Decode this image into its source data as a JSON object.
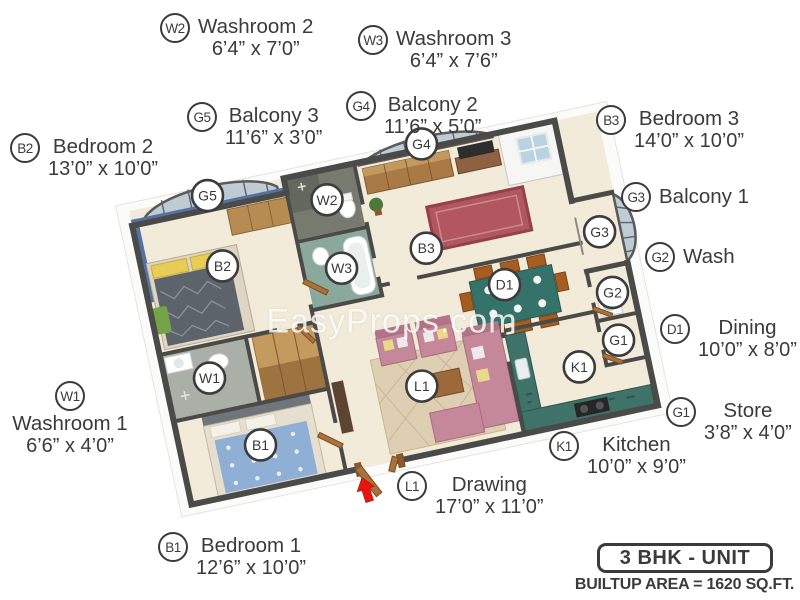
{
  "watermark": "EasyProps.com",
  "palette": {
    "ink": "#3b3b3b",
    "wall": "#4a4a48",
    "floor": "#f3ebd9",
    "accent_blue": "#5571a2",
    "kitchen_teal": "#3f7268",
    "sofa_pink": "#c5879a",
    "arrow_red": "#e81410",
    "glass": "#b9c8d2"
  },
  "legend": {
    "w2": {
      "code": "W2",
      "name": "Washroom 2",
      "dims": "6’4” x 7’0”"
    },
    "w3": {
      "code": "W3",
      "name": "Washroom 3",
      "dims": "6’4” x 7’6”"
    },
    "g5": {
      "code": "G5",
      "name": "Balcony 3",
      "dims": "11’6” x 3’0”"
    },
    "g4": {
      "code": "G4",
      "name": "Balcony 2",
      "dims": "11’6” x 5’0”"
    },
    "b3": {
      "code": "B3",
      "name": "Bedroom 3",
      "dims": "14’0” x 10’0”"
    },
    "b2": {
      "code": "B2",
      "name": "Bedroom 2",
      "dims": "13’0” x 10’0”"
    },
    "g3": {
      "code": "G3",
      "name": "Balcony 1"
    },
    "g2": {
      "code": "G2",
      "name": "Wash"
    },
    "d1": {
      "code": "D1",
      "name": "Dining",
      "dims": "10’0” x 8’0”"
    },
    "w1": {
      "code": "W1",
      "name": "Washroom 1",
      "dims": "6’6” x 4’0”"
    },
    "g1": {
      "code": "G1",
      "name": "Store",
      "dims": "3’8” x 4’0”"
    },
    "k1": {
      "code": "K1",
      "name": "Kitchen",
      "dims": "10’0” x 9’0”"
    },
    "l1": {
      "code": "L1",
      "name": "Drawing",
      "dims": "17’0” x 11’0”"
    },
    "b1": {
      "code": "B1",
      "name": "Bedroom 1",
      "dims": "12’6” x 10’0”"
    }
  },
  "plan_markers": {
    "g5": "G5",
    "w2": "W2",
    "g4": "G4",
    "w3": "W3",
    "b2": "B2",
    "b3": "B3",
    "w1": "W1",
    "d1": "D1",
    "g3": "G3",
    "g2": "G2",
    "g1": "G1",
    "k1": "K1",
    "l1": "L1",
    "b1": "B1"
  },
  "footer": {
    "unit_title": "3 BHK - UNIT",
    "builtup_area": "BUILTUP AREA = 1620 SQ.FT."
  }
}
